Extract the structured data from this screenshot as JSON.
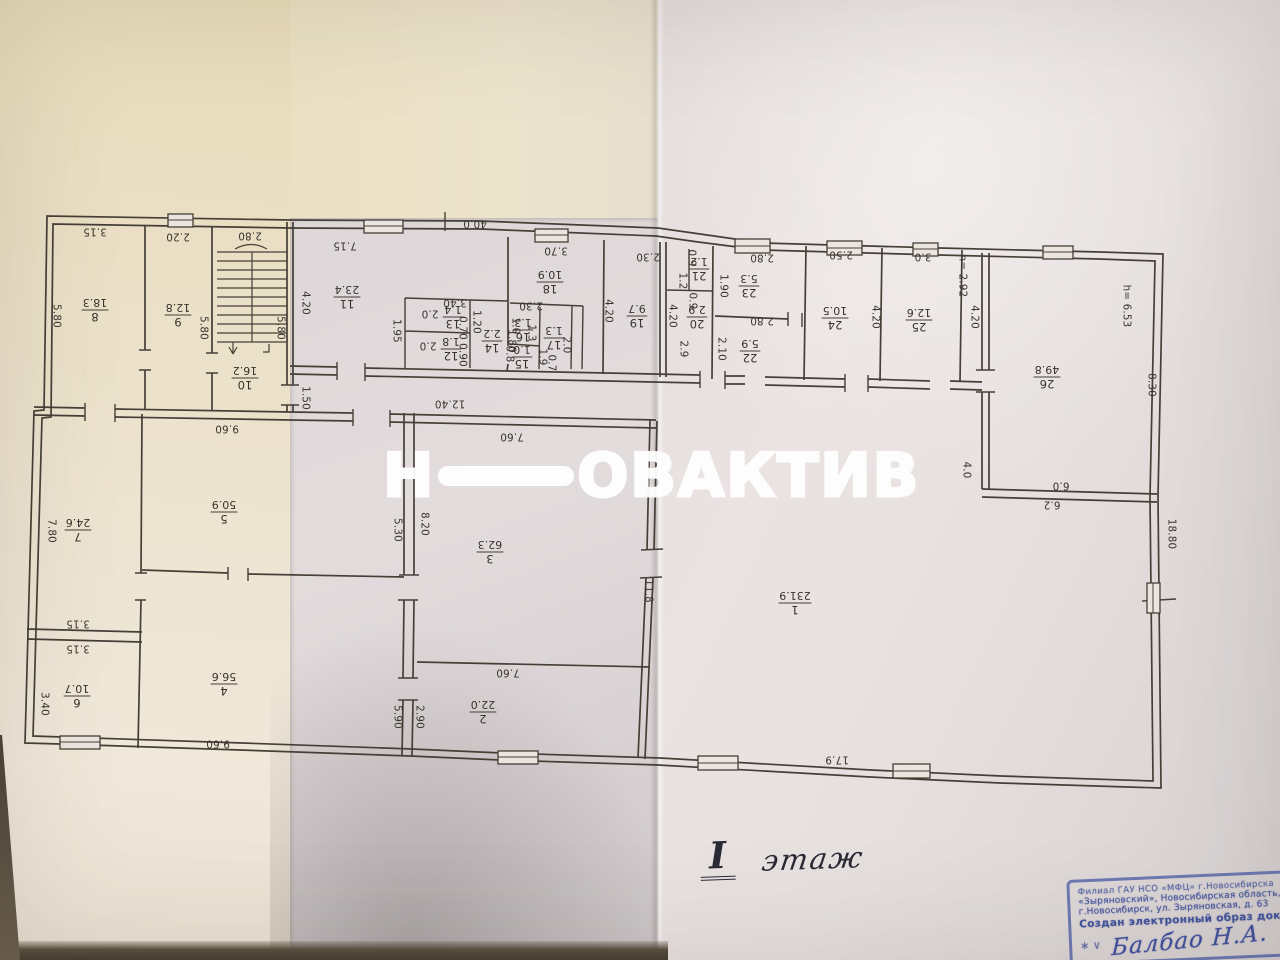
{
  "photo": {
    "description": "Фотография листа технического плана здания, 1 этаж"
  },
  "watermark": {
    "part1": "Н",
    "part2": "ОВАКТИВ"
  },
  "floor_note": {
    "numeral": "I",
    "word": "этаж"
  },
  "stamp": {
    "line1": "Филиал ГАУ НСО «МФЦ» г.Новосибирска",
    "line2": "«Зыряновский», Новосибирская область,",
    "line3": "г.Новосибирск, ул. Зыряновская, д. 63",
    "line4": "Создан электронный образ документа",
    "marks": "∗ ∨",
    "signature": "Балбао Н.А."
  },
  "plan": {
    "rooms": [
      {
        "n": "1",
        "a": "231.9",
        "x": 795,
        "y": 603
      },
      {
        "n": "2",
        "a": "22.0",
        "x": 483,
        "y": 712
      },
      {
        "n": "3",
        "a": "62.3",
        "x": 490,
        "y": 552
      },
      {
        "n": "4",
        "a": "56.6",
        "x": 224,
        "y": 684
      },
      {
        "n": "5",
        "a": "50.9",
        "x": 224,
        "y": 512
      },
      {
        "n": "6",
        "a": "10.7",
        "x": 77,
        "y": 696
      },
      {
        "n": "7",
        "a": "24.6",
        "x": 78,
        "y": 530
      },
      {
        "n": "8",
        "a": "18.3",
        "x": 95,
        "y": 310
      },
      {
        "n": "9",
        "a": "12.8",
        "x": 178,
        "y": 315
      },
      {
        "n": "10",
        "a": "16.2",
        "x": 245,
        "y": 378
      },
      {
        "n": "11",
        "a": "23.4",
        "x": 347,
        "y": 297
      },
      {
        "n": "12",
        "a": "1.8",
        "x": 451,
        "y": 349
      },
      {
        "n": "13",
        "a": "1.4",
        "x": 453,
        "y": 317
      },
      {
        "n": "14",
        "a": "2.2",
        "x": 492,
        "y": 341
      },
      {
        "n": "15",
        "a": "1.0",
        "x": 522,
        "y": 357
      },
      {
        "n": "16",
        "a": "1.3",
        "x": 523,
        "y": 330
      },
      {
        "n": "17",
        "a": "1.3",
        "x": 554,
        "y": 338
      },
      {
        "n": "18",
        "a": "10.9",
        "x": 550,
        "y": 282
      },
      {
        "n": "19",
        "a": "9.7",
        "x": 637,
        "y": 316
      },
      {
        "n": "20",
        "a": "2.9",
        "x": 697,
        "y": 317
      },
      {
        "n": "21",
        "a": "1.2",
        "x": 699,
        "y": 269
      },
      {
        "n": "22",
        "a": "5.9",
        "x": 750,
        "y": 351
      },
      {
        "n": "23",
        "a": "5.3",
        "x": 749,
        "y": 286
      },
      {
        "n": "24",
        "a": "10.5",
        "x": 835,
        "y": 318
      },
      {
        "n": "25",
        "a": "12.6",
        "x": 919,
        "y": 320
      },
      {
        "n": "26",
        "a": "49.8",
        "x": 1047,
        "y": 377
      }
    ],
    "dims": [
      {
        "t": "40.0",
        "x": 475,
        "y": 224,
        "r": 180
      },
      {
        "t": "7.15",
        "x": 345,
        "y": 246,
        "r": 180
      },
      {
        "t": "3.15",
        "x": 95,
        "y": 232,
        "r": 180
      },
      {
        "t": "2.20",
        "x": 178,
        "y": 237,
        "r": 180
      },
      {
        "t": "2.80",
        "x": 250,
        "y": 236,
        "r": 180
      },
      {
        "t": "5.80",
        "x": 57,
        "y": 316,
        "r": 90
      },
      {
        "t": "5.80",
        "x": 204,
        "y": 328,
        "r": 90
      },
      {
        "t": "5.80",
        "x": 281,
        "y": 328,
        "r": 90
      },
      {
        "t": "4.20",
        "x": 306,
        "y": 303,
        "r": 90
      },
      {
        "t": "1.50",
        "x": 306,
        "y": 398,
        "r": 90
      },
      {
        "t": "9.60",
        "x": 227,
        "y": 429,
        "r": 180
      },
      {
        "t": "3.40",
        "x": 455,
        "y": 303,
        "r": 180
      },
      {
        "t": "2.0",
        "x": 430,
        "y": 314,
        "r": 180
      },
      {
        "t": "2.0",
        "x": 428,
        "y": 346,
        "r": 180
      },
      {
        "t": "1.95",
        "x": 397,
        "y": 331,
        "r": 90
      },
      {
        "t": "0.70",
        "x": 463,
        "y": 328,
        "r": 90
      },
      {
        "t": "0.90",
        "x": 463,
        "y": 355,
        "r": 90
      },
      {
        "t": "1.20",
        "x": 477,
        "y": 322,
        "r": 90
      },
      {
        "t": "1.80",
        "x": 512,
        "y": 341,
        "r": 90
      },
      {
        "t": "2.30",
        "x": 531,
        "y": 306,
        "r": 180
      },
      {
        "t": "1.0",
        "x": 516,
        "y": 326,
        "r": 90
      },
      {
        "t": "1.3",
        "x": 532,
        "y": 333,
        "r": 90
      },
      {
        "t": "0.8",
        "x": 510,
        "y": 354,
        "r": 90
      },
      {
        "t": "1.9",
        "x": 543,
        "y": 357,
        "r": 90
      },
      {
        "t": "0.7",
        "x": 552,
        "y": 363,
        "r": 90
      },
      {
        "t": "2.0",
        "x": 567,
        "y": 345,
        "r": 90
      },
      {
        "t": "3.70",
        "x": 556,
        "y": 251,
        "r": 180
      },
      {
        "t": "2.30",
        "x": 648,
        "y": 257,
        "r": 180
      },
      {
        "t": "4.20",
        "x": 609,
        "y": 311,
        "r": 90
      },
      {
        "t": "4.20",
        "x": 673,
        "y": 316,
        "r": 90
      },
      {
        "t": "0.9",
        "x": 692,
        "y": 258,
        "r": 90
      },
      {
        "t": "1.2",
        "x": 683,
        "y": 281,
        "r": 90
      },
      {
        "t": "0.9",
        "x": 693,
        "y": 301,
        "r": 90
      },
      {
        "t": "2.9",
        "x": 684,
        "y": 349,
        "r": 90
      },
      {
        "t": "1.90",
        "x": 724,
        "y": 286,
        "r": 90
      },
      {
        "t": "2.80",
        "x": 762,
        "y": 258,
        "r": 180
      },
      {
        "t": "2.80",
        "x": 762,
        "y": 321,
        "r": 180
      },
      {
        "t": "2.10",
        "x": 722,
        "y": 349,
        "r": 90
      },
      {
        "t": "2.50",
        "x": 841,
        "y": 255,
        "r": 180
      },
      {
        "t": "3.0",
        "x": 923,
        "y": 257,
        "r": 180
      },
      {
        "t": "4.20",
        "x": 876,
        "y": 317,
        "r": 90
      },
      {
        "t": "4.20",
        "x": 975,
        "y": 317,
        "r": 90
      },
      {
        "t": "h= 2.92",
        "x": 963,
        "y": 276,
        "r": 90
      },
      {
        "t": "h= 6.53",
        "x": 1127,
        "y": 306,
        "r": 90
      },
      {
        "t": "8.30",
        "x": 1152,
        "y": 385,
        "r": 90
      },
      {
        "t": "4.0",
        "x": 967,
        "y": 470,
        "r": 90
      },
      {
        "t": "6.0",
        "x": 1061,
        "y": 486,
        "r": 180
      },
      {
        "t": "6.2",
        "x": 1052,
        "y": 505,
        "r": 180
      },
      {
        "t": "18.80",
        "x": 1172,
        "y": 534,
        "r": 90
      },
      {
        "t": "12.40",
        "x": 450,
        "y": 404,
        "r": 180
      },
      {
        "t": "7.60",
        "x": 512,
        "y": 437,
        "r": 180
      },
      {
        "t": "5.30",
        "x": 398,
        "y": 530,
        "r": 90
      },
      {
        "t": "8.20",
        "x": 425,
        "y": 524,
        "r": 90
      },
      {
        "t": "7.60",
        "x": 508,
        "y": 673,
        "r": 180
      },
      {
        "t": "5.90",
        "x": 398,
        "y": 717,
        "r": 90
      },
      {
        "t": "2.90",
        "x": 420,
        "y": 717,
        "r": 90
      },
      {
        "t": "11.8",
        "x": 649,
        "y": 591,
        "r": 90
      },
      {
        "t": "17.9",
        "x": 837,
        "y": 760,
        "r": 180
      },
      {
        "t": "7.80",
        "x": 52,
        "y": 531,
        "r": 90
      },
      {
        "t": "3.15",
        "x": 78,
        "y": 624,
        "r": 180
      },
      {
        "t": "3.15",
        "x": 78,
        "y": 649,
        "r": 180
      },
      {
        "t": "3.40",
        "x": 45,
        "y": 704,
        "r": 90
      },
      {
        "t": "9.60",
        "x": 218,
        "y": 744,
        "r": 180
      }
    ]
  }
}
